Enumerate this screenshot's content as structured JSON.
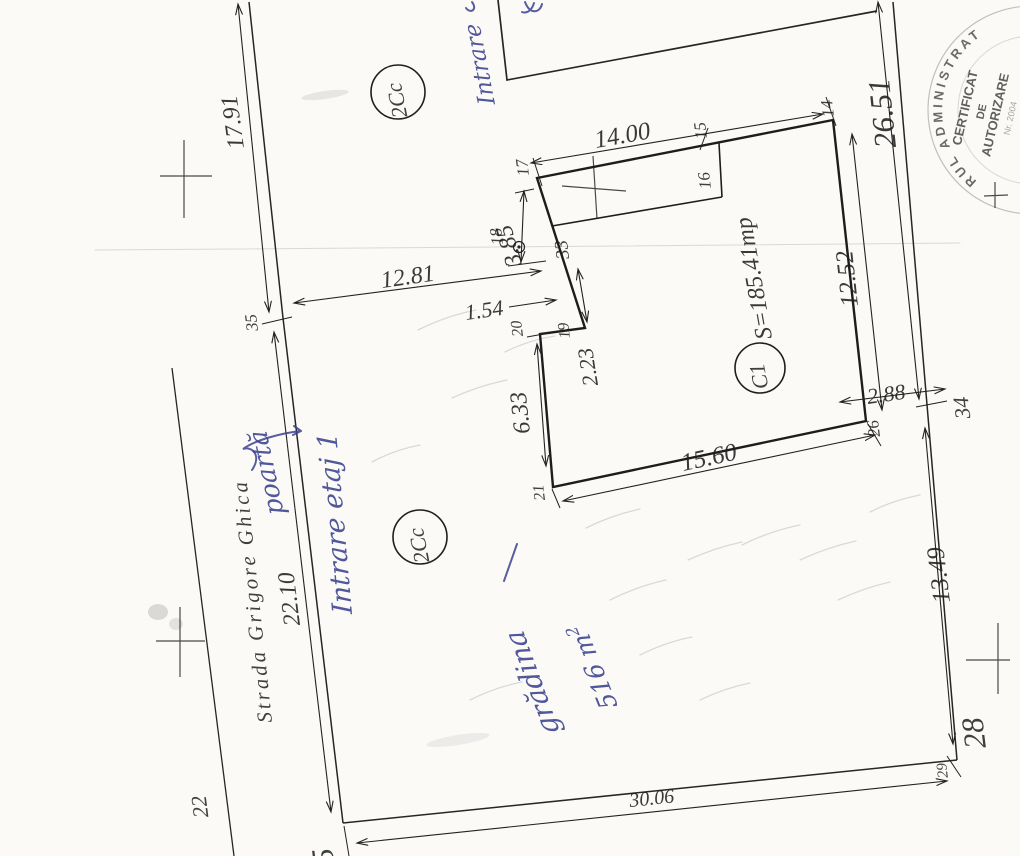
{
  "document": {
    "street": {
      "name": "Strada Grigore Ghica"
    },
    "zones": {
      "upper": "2Cc",
      "lower": "2Cc"
    },
    "building": {
      "id": "C1",
      "area": "S=185.41mp"
    },
    "dimensions": {
      "street_upper": "17.91",
      "street_lower": "22.10",
      "street_to_house": "12.81",
      "house_top": "14.00",
      "annex_left": "3.85",
      "step": "1.54",
      "recess": "2.23",
      "left_wall": "6.33",
      "right_wall": "12.52",
      "bottom_wall": "15.60",
      "house_to_boundary": "2.88",
      "right_upper": "26.51",
      "right_lower": "13.49",
      "bottom": "30.06"
    },
    "points": {
      "p5": "5",
      "p14": "14",
      "p15": "15",
      "p16": "16",
      "p17": "17",
      "p18": "18",
      "p19": "19",
      "p20": "20",
      "p21": "21",
      "p22": "22",
      "p26": "26",
      "p28": "28",
      "p29": "29",
      "p33": "33",
      "p34": "34",
      "p35": "35"
    },
    "handwritten": {
      "top_entrance": "Intrare",
      "floor_entrance": "Intrare etaj 1",
      "gate": "poartă",
      "garden": "grădina",
      "garden_area": "516 m",
      "garden_area_sup": "2"
    },
    "stamp": {
      "arc": "RUL ADMINISTRAT",
      "line1": "CERTIFICAT",
      "line2": "DE",
      "line3": "AUTORIZARE",
      "line4": "Nr. 2004"
    }
  }
}
